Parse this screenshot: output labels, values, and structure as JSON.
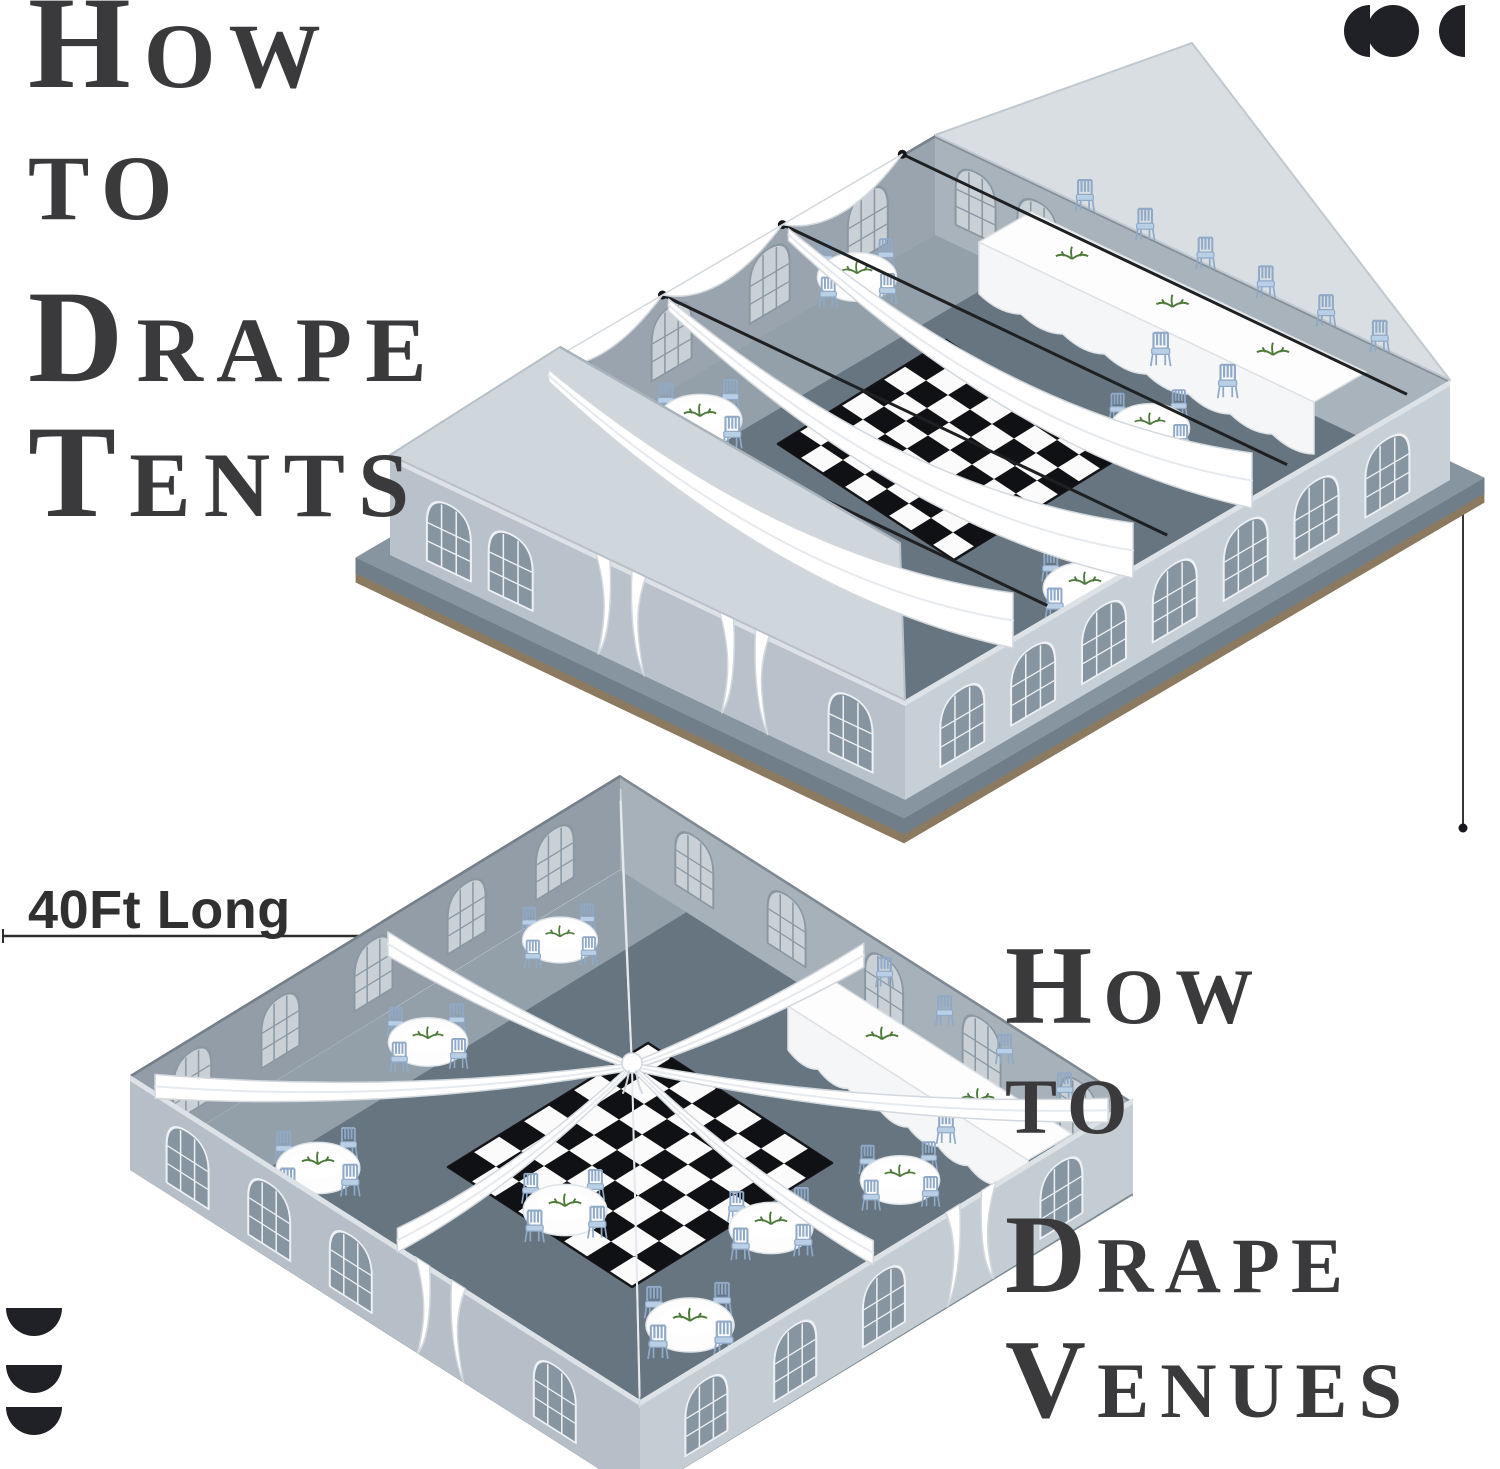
{
  "canvas": {
    "width": 1500,
    "height": 1469,
    "background": "#ffffff"
  },
  "headings": {
    "color": "#3a3a3c",
    "tents": {
      "lines": [
        "How",
        "to",
        "Drape",
        "Tents"
      ]
    },
    "venues": {
      "lines": [
        "How",
        "to",
        "Drape",
        "Venues"
      ]
    }
  },
  "dimension": {
    "length_label": "40Ft Long",
    "color": "#303030"
  },
  "icons": {
    "top_right": "brand-dots-logo",
    "bottom_left": "stacked-half-discs-logo",
    "color": "#1f2126"
  },
  "illustrations": {
    "tent": {
      "label": "draped frame tent",
      "round_tables": 6,
      "banquet_tables": 1,
      "ceiling_drapes": 3,
      "wall_swags": 3,
      "cables": 4,
      "dance_floor": "black-white-checkered"
    },
    "venue": {
      "label": "draped open-top venue",
      "round_tables": 7,
      "banquet_tables": 1,
      "radial_drapes": 8,
      "dance_floor": "black-white-checkered"
    }
  },
  "palette": {
    "floorLight": "#93a0aa",
    "floorDark": "#66757f",
    "floorStrip": "#7d8b95",
    "wallNW": "#99a4ae",
    "wallNE": "#a9b3bb",
    "wallSE": "#c8d0d7",
    "wallSW": "#b9c2ca",
    "vWallNW": "#929da7",
    "vWallNE": "#a7b1ba",
    "vWallSW": "#b6bfc7",
    "vWallSE": "#c5cdd4",
    "topStrip": "#dde2e7",
    "gable": "#d9dee3",
    "roof": "#cfd6dc",
    "roofEdge": "#aab4bc",
    "platform": "#8695a0",
    "platformSide": "#6f7e89",
    "platformBrown": "#8b7a60",
    "glassDark": "#8795a1",
    "glassLight": "#c9d1d7",
    "frameLight": "#eef1f4",
    "frameDark": "#8b97a1",
    "drape": "#ffffff",
    "drapeEdge": "#d2d8dd",
    "drapeShade": "#e6eaee",
    "cable": "#1e2022",
    "chair": "#b9cfe6",
    "chairStroke": "#8fa9c7",
    "cloth": "#fdfdfe",
    "clothEdge": "#dde2e7",
    "clothShade": "#f4f6f8",
    "boardBlack": "#101114",
    "boardWhite": "#fbfbfb",
    "green": "#4d7a3a"
  }
}
